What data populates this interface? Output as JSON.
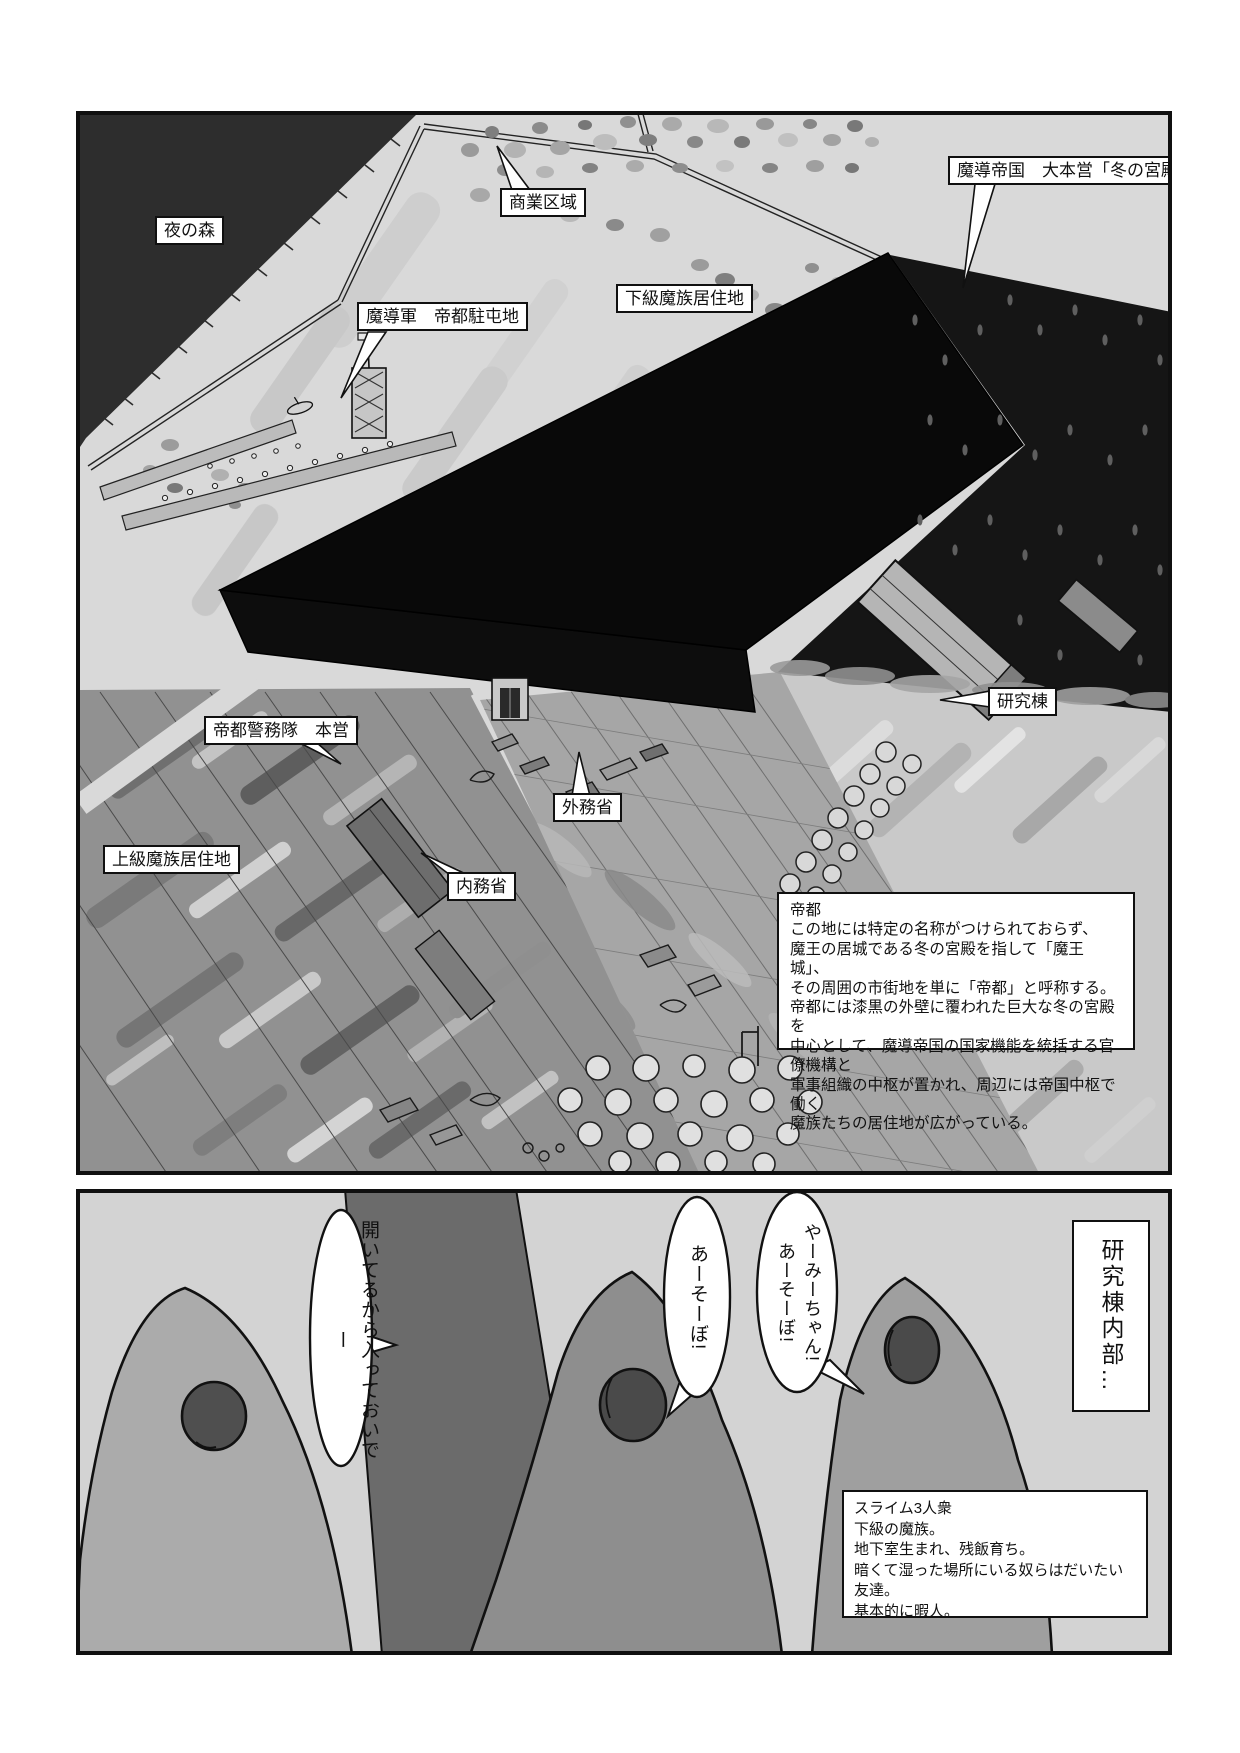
{
  "page_type": "manga-page",
  "colors": {
    "ink": "#101010",
    "panel1_bg": "#d9d9d9",
    "panel2_bg": "#d3d3d3",
    "palace_black": "#0a0a0a",
    "forest_dark": "#161616",
    "door_gray": "#6b6b6b",
    "slime_gray": "#9b9b9b"
  },
  "panel1": {
    "labels": [
      {
        "id": "night-forest",
        "text": "夜の森"
      },
      {
        "id": "commercial-district",
        "text": "商業区域"
      },
      {
        "id": "imperial-hq",
        "text": "魔導帝国　大本営「冬の宮殿」"
      },
      {
        "id": "army-garrison",
        "text": "魔導軍　帝都駐屯地"
      },
      {
        "id": "lower-demon-residence",
        "text": "下級魔族居住地"
      },
      {
        "id": "research-building",
        "text": "研究棟"
      },
      {
        "id": "police-hq",
        "text": "帝都警務隊　本営"
      },
      {
        "id": "foreign-ministry",
        "text": "外務省"
      },
      {
        "id": "interior-ministry",
        "text": "内務省"
      },
      {
        "id": "upper-demon-residence",
        "text": "上級魔族居住地"
      }
    ],
    "info_box": {
      "title": "帝都",
      "body": "この地には特定の名称がつけられておらず、\n魔王の居城である冬の宮殿を指して「魔王城」、\nその周囲の市街地を単に「帝都」と呼称する。\n帝都には漆黒の外壁に覆われた巨大な冬の宮殿を\n中心として、魔導帝国の国家機能を統括する官僚機構と\n軍事組織の中枢が置かれ、周辺には帝国中枢で働く\n魔族たちの居住地が広がっている。"
    }
  },
  "panel2": {
    "caption": "研究棟内部…",
    "bubbles": [
      {
        "speaker": "slime-right",
        "text": "やーみーちゃん!\nあーそーぼ!"
      },
      {
        "speaker": "slime-middle",
        "text": "あーそーぼ!"
      },
      {
        "speaker": "yami-behind-door",
        "text": "開いてるから入っておいでー"
      }
    ],
    "info_box": {
      "body": "スライム3人衆\n下級の魔族。\n地下室生まれ、残飯育ち。\n暗くて湿った場所にいる奴らはだいたい友達。\n基本的に暇人。"
    }
  }
}
